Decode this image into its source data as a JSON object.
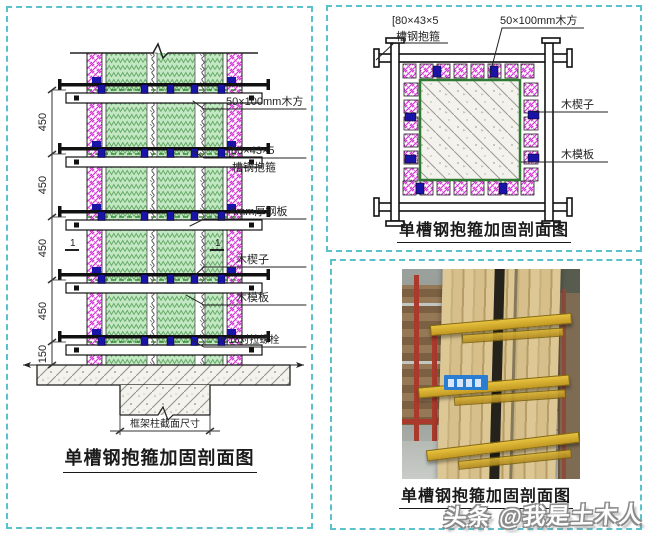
{
  "colors": {
    "panel_border_teal": "#5bc1cd",
    "hatch_magenta": "#d63ad6",
    "hatch_green_fill": "#c3e8c4",
    "hatch_green_line": "#6aab6a",
    "wedge_navy": "#1a13a8",
    "formwork_green_line": "#2f7a33",
    "dashed_green": "#1c7a1c",
    "concrete_bg": "#f3f2ed",
    "clamp_yellow": "#d8ae2e",
    "scaffold_red": "#a93a2c",
    "sign_blue": "#2b7dd1",
    "linework": "#222222"
  },
  "section_panel": {
    "dims": [
      "450",
      "450",
      "450",
      "450",
      "150"
    ],
    "labels": {
      "wood_square": "50×100mm木方",
      "channel_line1": "[80×43×5",
      "channel_line2": "槽钢抱箍",
      "steel_plate": "4mm厚钢板",
      "wedge": "木楔子",
      "formwork": "木模板",
      "bolt": "M16对拉螺栓",
      "column_size": "框架柱截面尺寸",
      "section_mark": "1"
    },
    "caption": "单槽钢抱箍加固剖面图"
  },
  "plan_panel": {
    "labels": {
      "channel_line1": "[80×43×5",
      "channel_line2": "槽钢抱箍",
      "wood_square": "50×100mm木方",
      "wedge": "木楔子",
      "formwork": "木模板"
    },
    "caption": "单槽钢抱箍加固剖面图"
  },
  "photo_panel": {
    "caption": "单槽钢抱箍加固剖面图"
  },
  "watermark": {
    "text": "头条 @我是土木人"
  }
}
